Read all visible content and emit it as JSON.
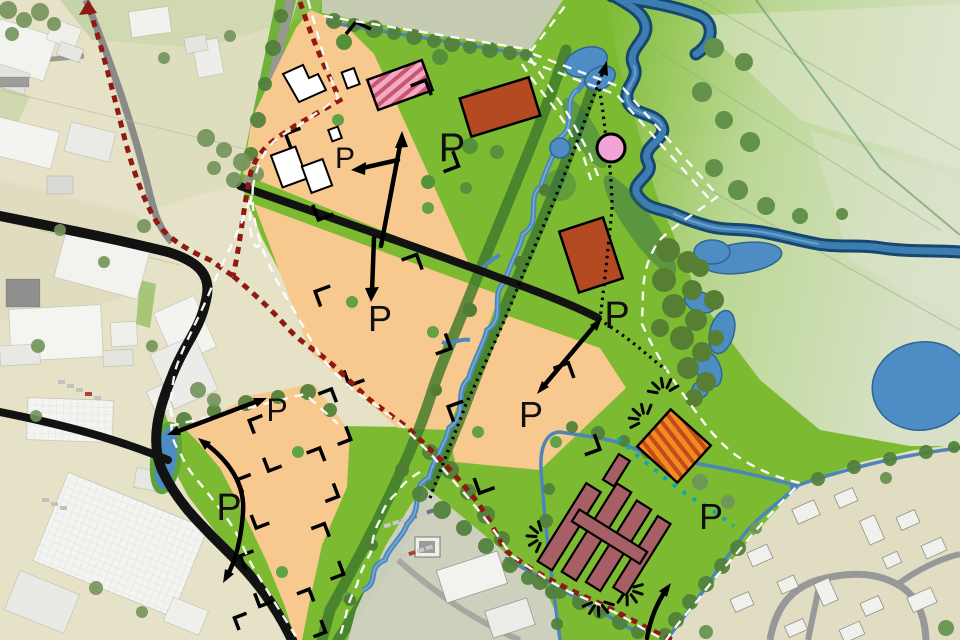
{
  "map": {
    "parking_label": "P",
    "parking_markers": [
      {
        "id": "plot-northwest",
        "x": 345,
        "y": 168,
        "size": 30
      },
      {
        "id": "green-north",
        "x": 452,
        "y": 161,
        "size": 40
      },
      {
        "id": "plot-central",
        "x": 380,
        "y": 331,
        "size": 36
      },
      {
        "id": "road-end-east",
        "x": 617,
        "y": 328,
        "size": 38
      },
      {
        "id": "plot-east",
        "x": 531,
        "y": 427,
        "size": 36
      },
      {
        "id": "plot-southwest-upper",
        "x": 277,
        "y": 421,
        "size": 32
      },
      {
        "id": "plot-southwest-lower",
        "x": 229,
        "y": 520,
        "size": 38
      },
      {
        "id": "farmstead-east",
        "x": 711,
        "y": 529,
        "size": 36
      }
    ],
    "palette": {
      "base_green": "#7CBB31",
      "corridor_green": "#3F7A2C",
      "faded_fields": "#DCE3CD",
      "existing_area_beige": "#E5E2C8",
      "residential_beige": "#E0DDC2",
      "plot_orange": "#F8C98E",
      "river_blue": "#17466F",
      "pond_blue": "#4E8CC4",
      "stream_blue": "#4C88BA",
      "boundary_red": "#8E1A12",
      "boundary_white": "#FFFFFF",
      "path_teal": "#12A5B4",
      "building_red": "#B34A22",
      "building_pink": "#F2A9C5",
      "farm_maroon": "#A75F66",
      "hatch_orange": "#F18A1F",
      "landmark_pink_circle": "#F0A3D4",
      "road_black": "#121212"
    },
    "features": [
      "existing-industrial-area",
      "development-plots",
      "building-envelopes",
      "stream-corridor",
      "river",
      "wetland-park",
      "farmstead-parcel",
      "residential-area",
      "plan-boundary",
      "pedestrian-paths",
      "parking-markers",
      "landmark-circle"
    ]
  }
}
